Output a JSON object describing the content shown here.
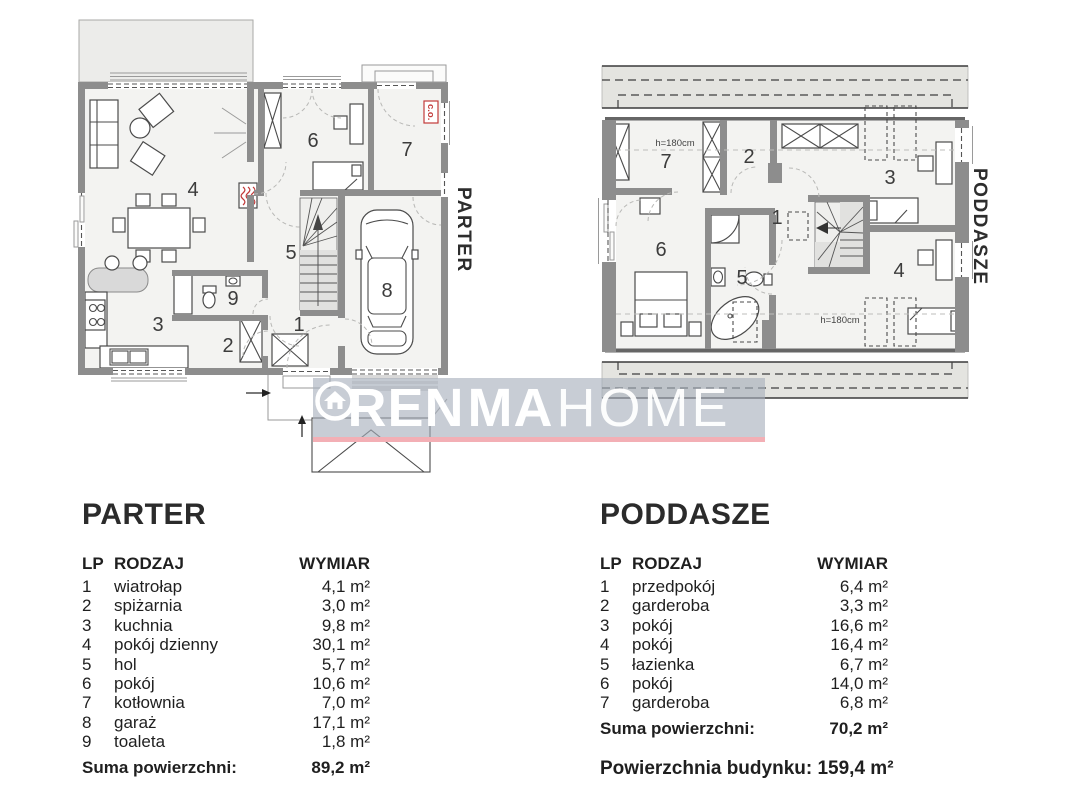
{
  "watermark": {
    "pre": "REN",
    "mid": "MA",
    "post": "HOME"
  },
  "parter": {
    "side_label": "PARTER",
    "co": "c.o.",
    "rooms": {
      "r1": "1",
      "r2": "2",
      "r3": "3",
      "r4": "4",
      "r5": "5",
      "r6": "6",
      "r7": "7",
      "r8": "8",
      "r9": "9"
    }
  },
  "poddasze": {
    "side_label": "PODDASZE",
    "h_top": "h=180cm",
    "h_bottom": "h=180cm",
    "rooms": {
      "r1": "1",
      "r2": "2",
      "r3": "3",
      "r4": "4",
      "r5": "5",
      "r6": "6",
      "r7": "7"
    }
  },
  "tables": {
    "parter": {
      "title": "PARTER",
      "columns": {
        "lp": "LP",
        "rodzaj": "RODZAJ",
        "wymiar": "WYMIAR"
      },
      "rows": [
        {
          "lp": "1",
          "rodzaj": "wiatrołap",
          "wymiar": "4,1 m²"
        },
        {
          "lp": "2",
          "rodzaj": "spiżarnia",
          "wymiar": "3,0 m²"
        },
        {
          "lp": "3",
          "rodzaj": "kuchnia",
          "wymiar": "9,8 m²"
        },
        {
          "lp": "4",
          "rodzaj": "pokój dzienny",
          "wymiar": "30,1 m²"
        },
        {
          "lp": "5",
          "rodzaj": "hol",
          "wymiar": "5,7 m²"
        },
        {
          "lp": "6",
          "rodzaj": "pokój",
          "wymiar": "10,6 m²"
        },
        {
          "lp": "7",
          "rodzaj": "kotłownia",
          "wymiar": "7,0 m²"
        },
        {
          "lp": "8",
          "rodzaj": "garaż",
          "wymiar": "17,1 m²"
        },
        {
          "lp": "9",
          "rodzaj": "toaleta",
          "wymiar": "1,8 m²"
        }
      ],
      "sum_label": "Suma powierzchni:",
      "sum_value": "89,2 m²"
    },
    "poddasze": {
      "title": "PODDASZE",
      "columns": {
        "lp": "LP",
        "rodzaj": "RODZAJ",
        "wymiar": "WYMIAR"
      },
      "rows": [
        {
          "lp": "1",
          "rodzaj": "przedpokój",
          "wymiar": "6,4 m²"
        },
        {
          "lp": "2",
          "rodzaj": "garderoba",
          "wymiar": "3,3 m²"
        },
        {
          "lp": "3",
          "rodzaj": "pokój",
          "wymiar": "16,6 m²"
        },
        {
          "lp": "4",
          "rodzaj": "pokój",
          "wymiar": "16,4 m²"
        },
        {
          "lp": "5",
          "rodzaj": "łazienka",
          "wymiar": "6,7 m²"
        },
        {
          "lp": "6",
          "rodzaj": "pokój",
          "wymiar": "14,0 m²"
        },
        {
          "lp": "7",
          "rodzaj": "garderoba",
          "wymiar": "6,8 m²"
        }
      ],
      "sum_label": "Suma powierzchni:",
      "sum_value": "70,2 m²"
    }
  },
  "footer": {
    "label": "Powierzchnia budynku:",
    "value": "159,4 m²"
  }
}
